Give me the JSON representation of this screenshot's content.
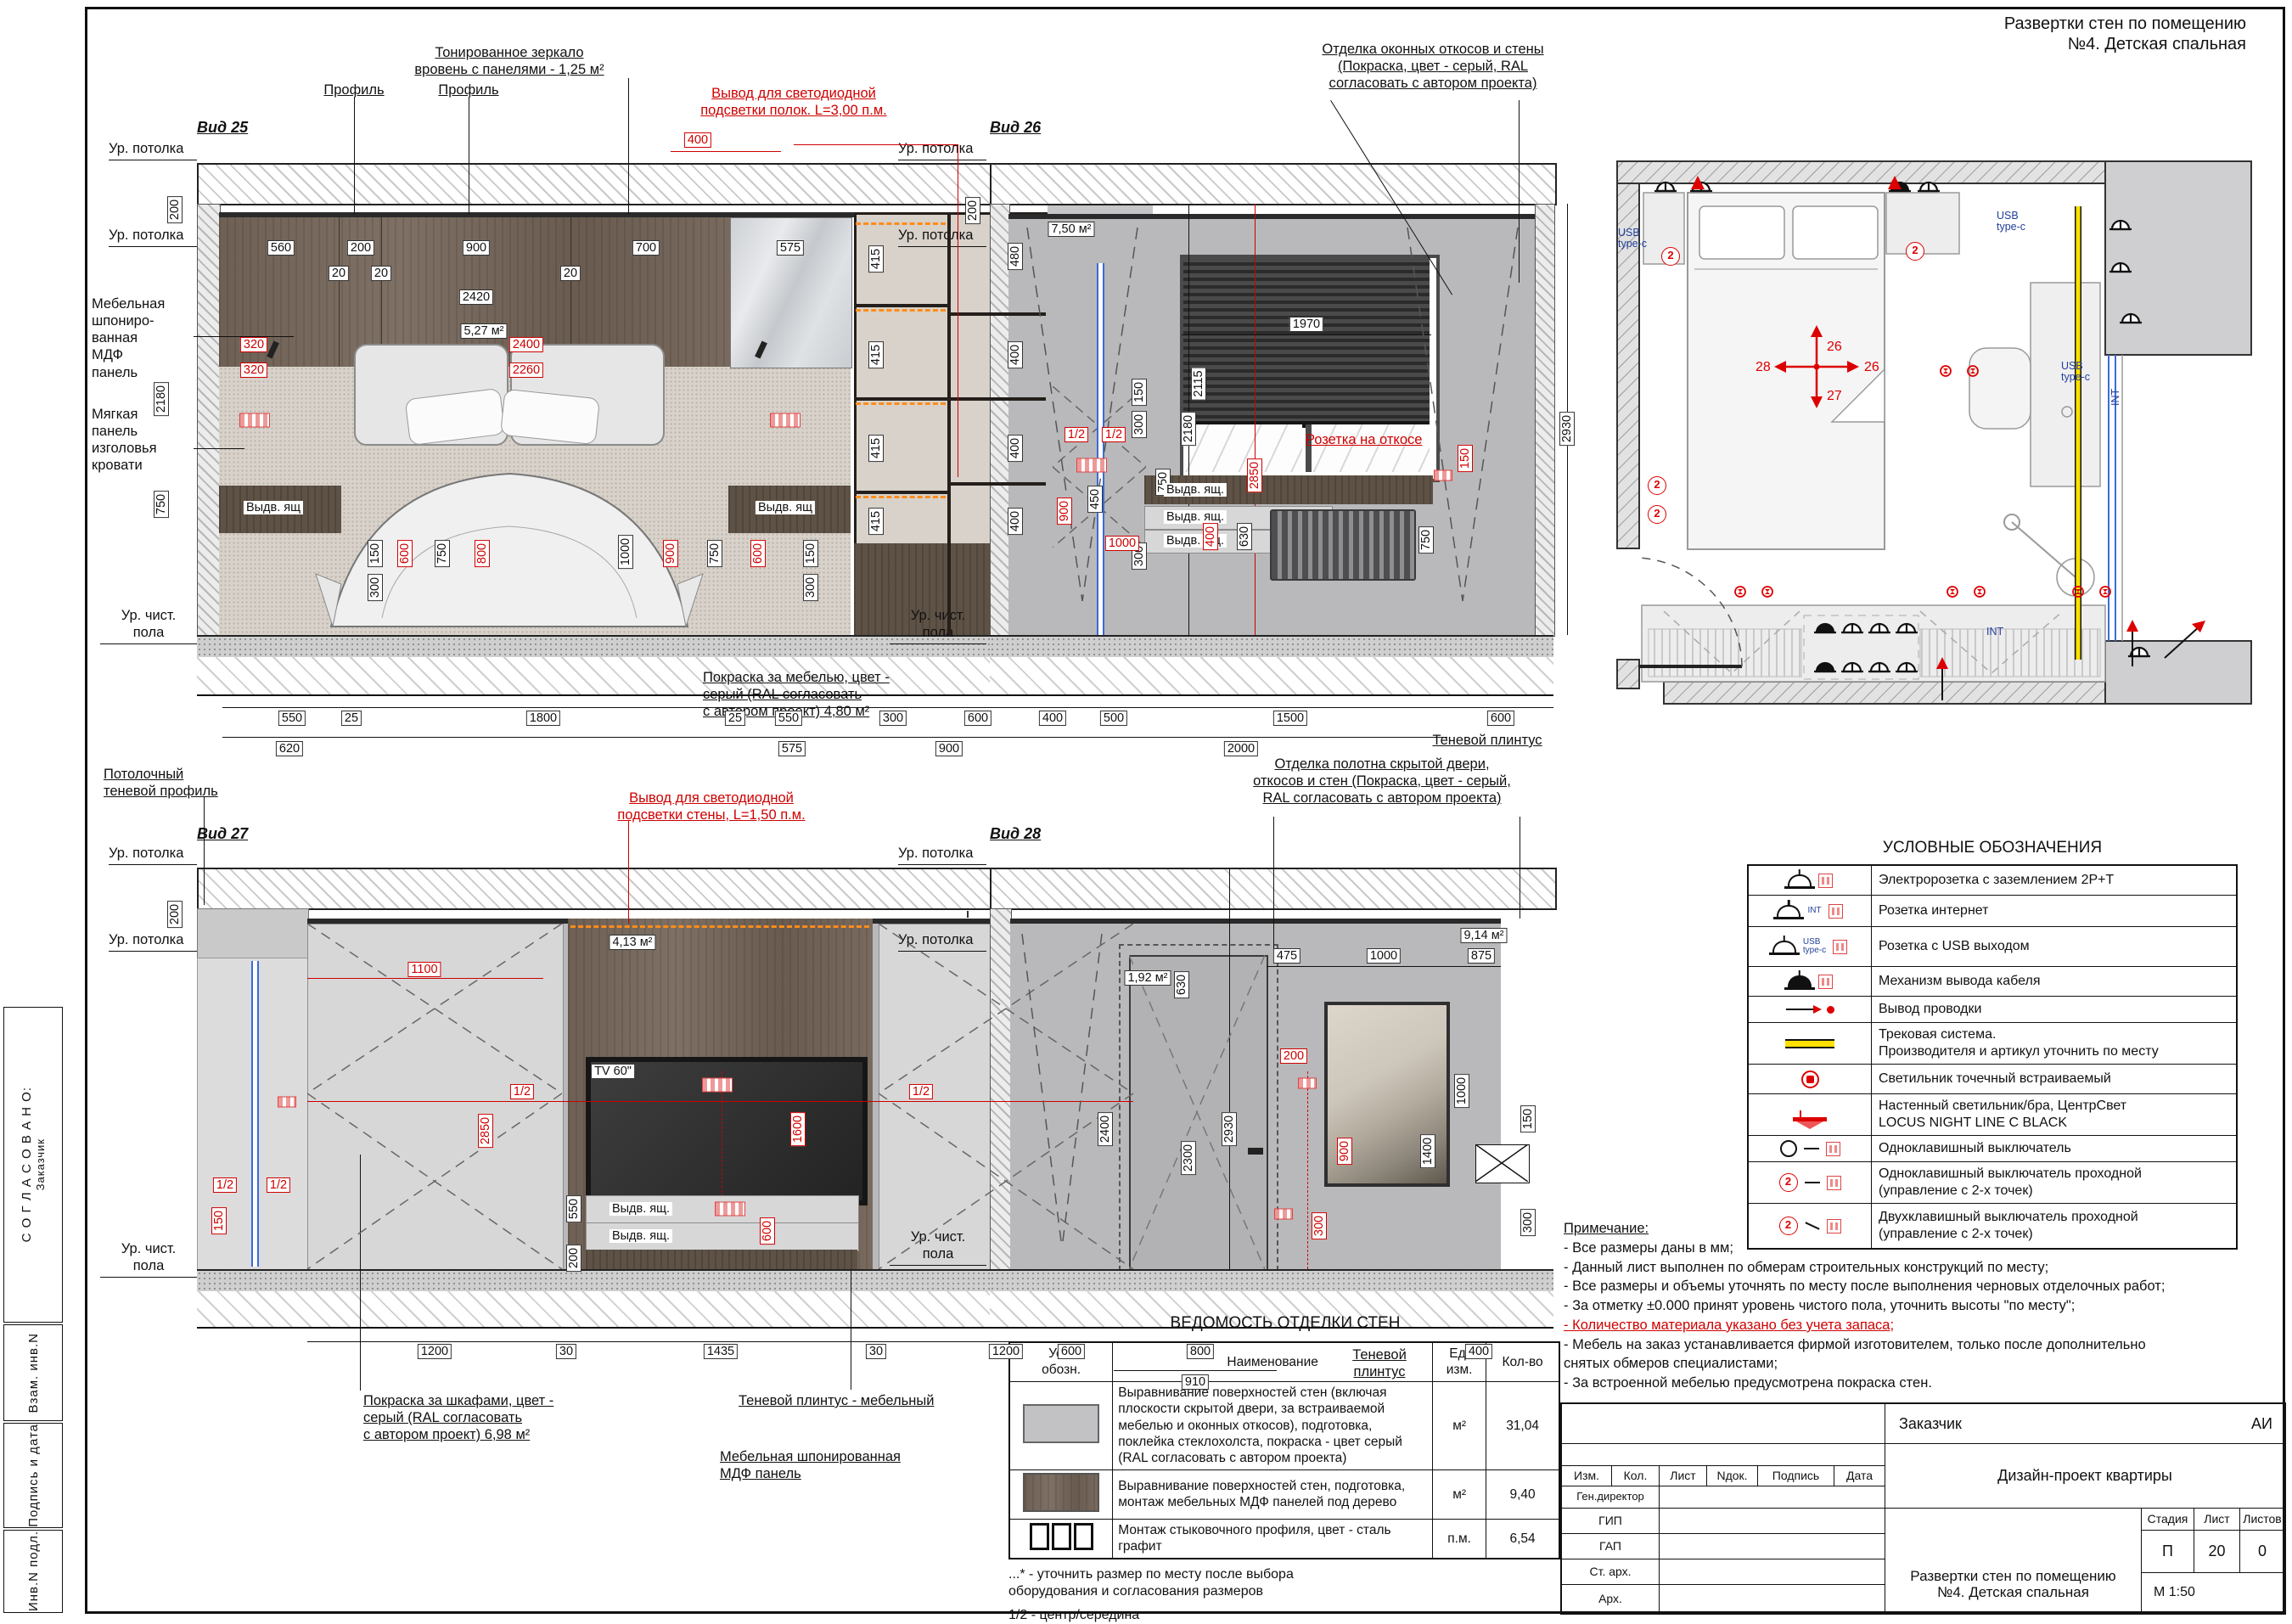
{
  "header": {
    "title": "Развертки стен по помещению\n№4. Детская спальная"
  },
  "sidebar": {
    "agreed": "С О Г Л А С О В А Н О:",
    "customer": "Заказчик",
    "rows": [
      "Взам. инв.N",
      "Подпись и дата",
      "Инв.N подл."
    ]
  },
  "common": {
    "lvl_ceiling": "Ур. потолка",
    "lvl_floor": "Ур. чист.\nпола"
  },
  "v25": {
    "title": "Вид 25",
    "mirror_note": "Тонированное зеркало\nвровень с панелями - 1,25 м²",
    "profile": "Профиль",
    "led_note": "Вывод для светодиодной\nподсветки полок. L=3,00 п.м.",
    "mdf_note": "Мебельная\nшпониро-\nванная\nМДФ\nпанель",
    "soft_note": "Мягкая\nпанель\nизголовья\nкровати",
    "area": "5,27 м²",
    "drawer": "Выдв. ящ",
    "paint_note": "Покраска за мебелью, цвет -\nсерый (RAL согласовать\nс автором проект) 4,80 м²",
    "shadow_note": "Потолочный\nтеневой профиль",
    "top": [
      "560",
      "200",
      "900",
      "700",
      "575"
    ],
    "t20": [
      "20",
      "20",
      "20"
    ],
    "d2420": "2420",
    "red": [
      "320",
      "2400",
      "320",
      "2260",
      "400",
      "2850",
      "600",
      "800",
      "900",
      "600"
    ],
    "shelf": [
      "415",
      "415",
      "415",
      "415",
      "480",
      "400",
      "400",
      "400"
    ],
    "left": [
      "200",
      "2180",
      "750"
    ],
    "right": [
      "150",
      "300",
      "750",
      "300",
      "2180"
    ],
    "bed": [
      "300",
      "150",
      "750",
      "1000",
      "750",
      "150",
      "300"
    ],
    "bot1": [
      "550",
      "25",
      "1800",
      "25",
      "550",
      "300",
      "600"
    ],
    "bot2": [
      "620",
      "575",
      "900"
    ]
  },
  "v26": {
    "title": "Вид 26",
    "note": "Отделка оконных откосов и стены\n(Покраска, цвет - серый, RAL\nсогласовать с автором проекта)",
    "area": "7,50 м²",
    "socket_note": "Розетка на откосе",
    "drawer": "Выдв. ящ.",
    "plinth": "Теневой плинтус",
    "d200": "200",
    "d1970": "1970",
    "d2115": "2115",
    "d2930": "2930",
    "half": "1/2",
    "r150": "150",
    "r900": "900",
    "d450": "450",
    "r1000": "1000",
    "r400": "400",
    "d630": "630",
    "d750": "750",
    "bot1": [
      "400",
      "500",
      "1500",
      "600"
    ],
    "d2000": "2000"
  },
  "v27": {
    "title": "Вид 27",
    "led_note": "Вывод для светодиодной\nподсветки стены, L=1,50 п.м.",
    "area": "4,13 м²",
    "tv": "TV 60\"",
    "drawer": "Выдв.\nящ.",
    "paint_note": "Покраска за шкафами, цвет -\nсерый (RAL согласовать\nс автором проект) 6,98 м²",
    "plinth_note": "Теневой плинтус - мебельный",
    "mdf_note": "Мебельная шпонированная\nМДФ панель",
    "r1100": "1100",
    "r2850": "2850",
    "d630": "630",
    "d2930": "2930",
    "d2300": "2300",
    "half": "1/2",
    "r150": "150",
    "r1600": "1600",
    "d550": "550",
    "d200": "200",
    "d200b": "200",
    "r600": "600",
    "bot": [
      "1200",
      "30",
      "1435",
      "30",
      "1200"
    ]
  },
  "v28": {
    "title": "Вид 28",
    "note": "Отделка полотна скрытой двери,\nоткосов и стен (Покраска, цвет - серый,\nRAL согласовать с автором проекта)",
    "area_wall": "9,14 м²",
    "area_door": "1,92 м²",
    "plinth": "Теневой\nплинтус",
    "top": [
      "475",
      "1000",
      "875"
    ],
    "d1000": "1000",
    "d2400": "2400",
    "r200": "200",
    "r900": "900",
    "r300": "300",
    "d1400": "1400",
    "d150": "150",
    "d300": "300",
    "bot": [
      "600",
      "800"
    ],
    "d910": "910",
    "d400": "400"
  },
  "plan": {
    "usb": "USB\ntype-c",
    "int": "INT",
    "m_up": "26",
    "m_right": "26",
    "m_down": "27",
    "m_left": "28",
    "sw": "2"
  },
  "legend": {
    "title": "УСЛОВНЫЕ ОБОЗНАЧЕНИЯ",
    "icon_usb": "USB\ntype-c",
    "icon_int": "INT",
    "sw2": "2",
    "rows": [
      "Электророзетка с заземлением 2P+T",
      "Розетка интернет",
      "Розетка с USB выходом",
      "Механизм вывода кабеля",
      "Вывод проводки",
      "Трековая система.\nПроизводителя и артикул уточнить по месту",
      "Светильник точечный встраиваемый",
      "Настенный светильник/бра, ЦентрСвет\nLOCUS NIGHT LINE C BLACK",
      "Одноклавишный выключатель",
      "Одноклавишный выключатель проходной\n(управление с 2-х точек)",
      "Двухклавишный выключатель проходной\n(управление с 2-х точек)"
    ]
  },
  "notes": {
    "title": "Примечание:",
    "items": [
      "- Все размеры даны в мм;",
      "- Данный лист выполнен по обмерам строительных конструкций по месту;",
      "- Все размеры и объемы уточнять по месту после выполнения черновых отделочных работ;",
      "- За отметку ±0.000 принят уровень чистого пола, уточнить высоты \"по месту\";",
      "- Количество материала указано без учета запаса;",
      "- Мебель на заказ устанавливается фирмой изготовителем, только после дополнительно\n  снятых обмеров специалистами;",
      "- За встроенной мебелью предусмотрена покраска стен."
    ]
  },
  "schedule": {
    "title": "ВЕДОМОСТЬ ОТДЕЛКИ СТЕН",
    "headers": [
      "Усл.\nобозн.",
      "Наименование",
      "Ед.\nизм.",
      "Кол-во"
    ],
    "rows": [
      {
        "name": "Выравнивание поверхностей стен (включая\nплоскости скрытой двери, за встраиваемой\nмебелью и оконных откосов), подготовка,\nпоклейка стеклохолста, покраска - цвет серый\n(RAL согласовать с автором проекта)",
        "unit": "м²",
        "qty": "31,04"
      },
      {
        "name": "Выравнивание поверхностей стен, подготовка,\nмонтаж мебельных МДФ панелей под дерево",
        "unit": "м²",
        "qty": "9,40"
      },
      {
        "name": "Монтаж стыковочного профиля, цвет - сталь графит",
        "unit": "п.м.",
        "qty": "6,54"
      }
    ],
    "fn1": "...*  - уточнить размер по месту после выбора\n         оборудования и согласования размеров",
    "fn2": "1/2  - центр/середина"
  },
  "titleblock": {
    "customer_label": "Заказчик",
    "customer_value": "АИ",
    "project": "Дизайн-проект квартиры",
    "cols": [
      "Изм.",
      "Кол.",
      "Лист",
      "Nдок.",
      "Подпись",
      "Дата"
    ],
    "roles": [
      "Ген.директор",
      "ГИП",
      "ГАП",
      "Ст. арх.",
      "Арх."
    ],
    "stage_label": "Стадия",
    "sheet_label": "Лист",
    "sheets_label": "Листов",
    "stage": "П",
    "sheet": "20",
    "sheets": "0",
    "doc_title": "Развертки стен по помещению\n№4. Детская спальная",
    "scale": "М 1:50"
  }
}
